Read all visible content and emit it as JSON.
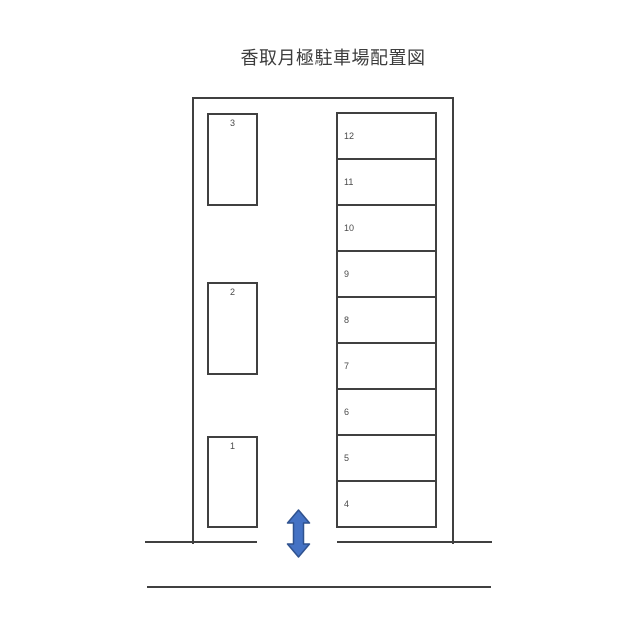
{
  "title": "香取月極駐車場配置図",
  "lot": {
    "left_column": {
      "spaces": [
        "3",
        "2",
        "1"
      ]
    },
    "right_column": {
      "spaces": [
        "12",
        "11",
        "10",
        "9",
        "8",
        "7",
        "6",
        "5",
        "4"
      ]
    }
  },
  "entrance": {
    "arrow_icon": "double-vertical-arrow"
  },
  "colors": {
    "line": "#404040",
    "number_text": "#4a4a4a",
    "title_text": "#3d3d3d",
    "arrow_fill": "#4472c4",
    "arrow_stroke": "#2f528f",
    "background": "#ffffff"
  }
}
